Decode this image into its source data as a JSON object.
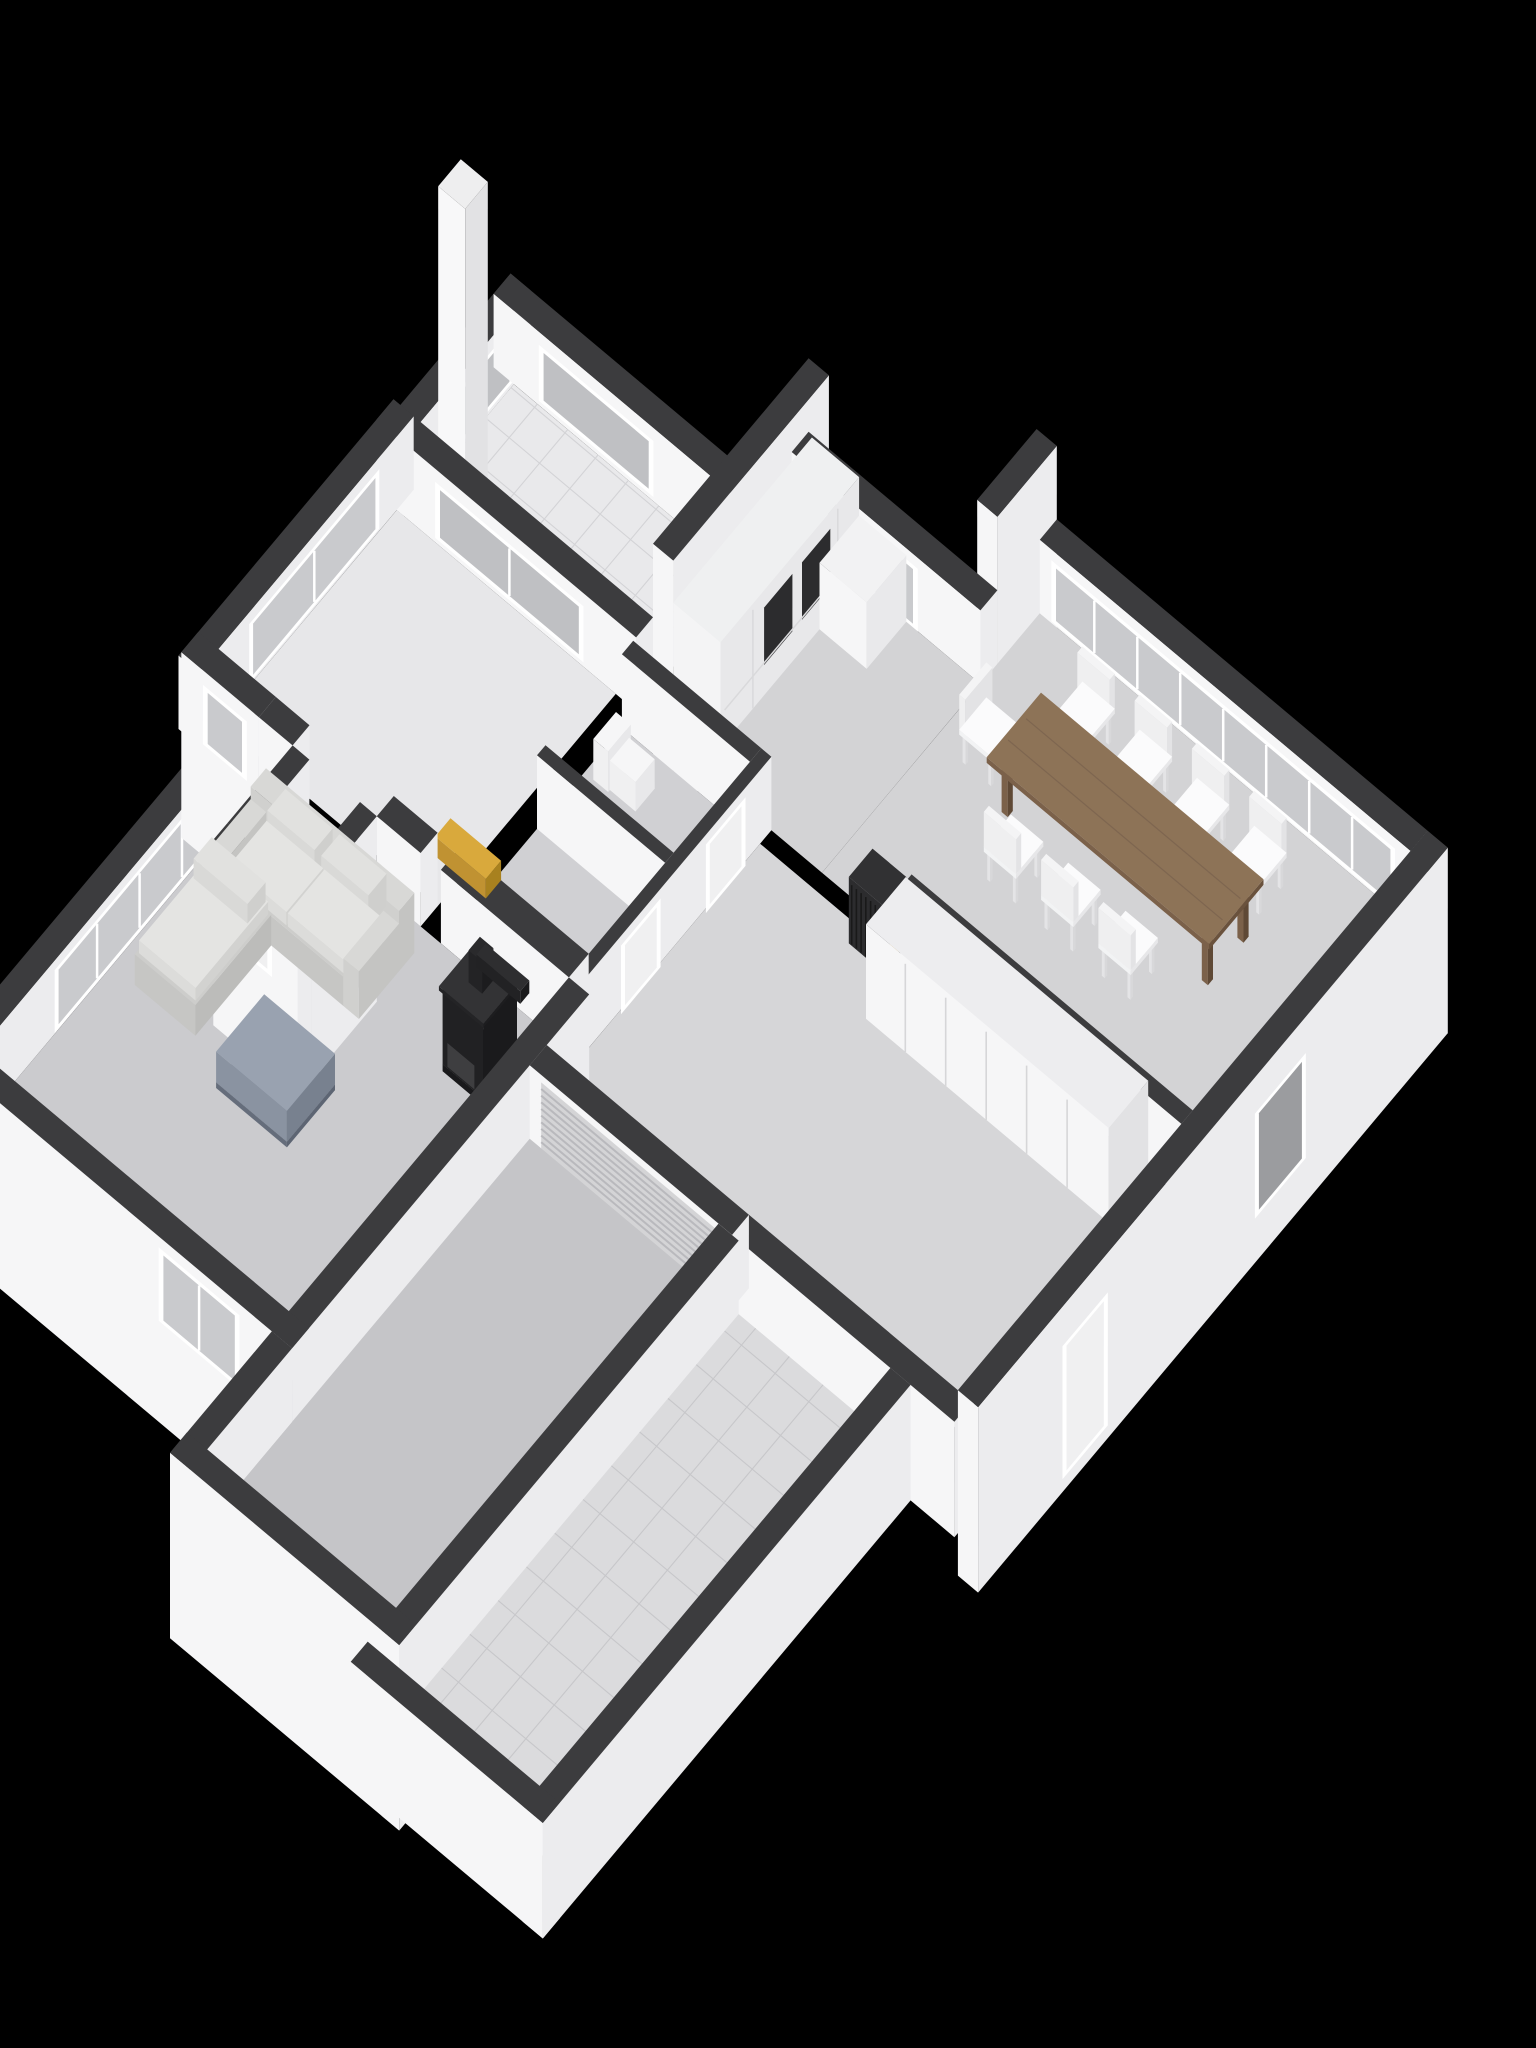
{
  "meta": {
    "kind": "3d-floorplan-axonometric-render",
    "background": "#000000",
    "floor_shown": "ground-floor",
    "visible_text": ""
  },
  "projection": {
    "ox": 520,
    "oy": 240,
    "s": 88,
    "c": 70,
    "ux": 0.766,
    "uy": 0.643,
    "vx": -0.643,
    "vy": 0.766
  },
  "palette": {
    "wallTop": "#3c3c3e",
    "wallV": "#f6f6f7",
    "wallU": "#ececee",
    "frame": "#ffffff",
    "glass": "#c9cacd",
    "glassFrost": "#bfc0c3",
    "glassDark": "#9b9c9f",
    "doorWhite": "#f0f0f1",
    "garageDoor": "#d4d4d6",
    "ribLine": "#b9b9bd",
    "tileA": "#e9e9eb",
    "tileAGrid": "#d3d3d6",
    "tileB": "#dbdbdd",
    "tileBGrid": "#c7c7ca",
    "floorBedroom": "#e7e7e9",
    "floorKitchen": "#d3d3d5",
    "floorCluster": "#d0d0d3",
    "floorCorridor": "#d6d6d8",
    "floorEntry": "#dedee0",
    "floorLiving": "#cbcbce",
    "floorGarage": "#c5c5c8",
    "wood": "#8d7357",
    "woodDark": "#6a523d",
    "woodSide": "#7b614a",
    "woodLeg": "#5f4936",
    "chairWhite": "#fbfbfc",
    "sofaBody": "#d8d8d6",
    "sofaBase": "#cdcdcb",
    "sofaCushion": "#e4e4e2",
    "ottomanTop": "#99a2b0",
    "ottomanU": "#78818f",
    "ottomanV": "#8a93a1",
    "stoveBlack": "#1a1a1c",
    "gold": "#d9a93c",
    "goldDark": "#a8811f",
    "goldMid": "#c09232",
    "radiatorDark": "#2c2c2e",
    "closetSeam": "#d6d6d8",
    "appliance": "#2c2c2e"
  },
  "scene": [
    {
      "name": "patio-floor",
      "type": "floor",
      "u": [
        1.0,
        4.45
      ],
      "v": [
        1.3,
        2.95
      ],
      "fill": "tileA",
      "grid": 0.45,
      "gridFill": "tileAGrid"
    },
    {
      "name": "patio-nw-wall",
      "type": "wall",
      "u": [
        0.7,
        1.0
      ],
      "v": [
        1.0,
        3.25
      ],
      "z": [
        0,
        1.05
      ]
    },
    {
      "name": "patio-nw-window",
      "type": "panel",
      "side": "u",
      "at": 1.0,
      "range": [
        1.35,
        2.6
      ],
      "z": [
        0.12,
        0.92
      ],
      "fill": "glassFrost",
      "frame": true
    },
    {
      "name": "patio-ne-wall",
      "type": "wall",
      "u": [
        0.7,
        4.45
      ],
      "v": [
        1.0,
        1.3
      ],
      "z": [
        0,
        1.05
      ]
    },
    {
      "name": "patio-ne-window",
      "type": "panel",
      "side": "v",
      "at": 1.3,
      "range": [
        1.4,
        3.1
      ],
      "z": [
        0.12,
        0.92
      ],
      "fill": "glassFrost",
      "frame": true
    },
    {
      "name": "chimney",
      "type": "wall",
      "u": [
        1.12,
        1.52
      ],
      "v": [
        2.38,
        2.78
      ],
      "z": [
        0,
        4.35
      ],
      "cols": {
        "t": "#eeeeef",
        "u": "#e2e2e4",
        "v": "#f8f8f9"
      }
    },
    {
      "name": "bedroom-ne-wall",
      "type": "wall",
      "u": [
        0.6,
        4.45
      ],
      "v": [
        2.95,
        3.25
      ],
      "z": [
        0,
        1.05
      ]
    },
    {
      "name": "bedroom-ne-window",
      "type": "panel",
      "side": "v",
      "at": 3.25,
      "range": [
        1.5,
        3.7
      ],
      "z": [
        0.12,
        0.92
      ],
      "fill": "glassFrost",
      "frame": true,
      "mull": 1
    },
    {
      "name": "bedroom-nw-wall",
      "type": "wall",
      "u": [
        0.6,
        0.9
      ],
      "v": [
        2.95,
        6.75
      ],
      "z": [
        0,
        1.05
      ]
    },
    {
      "name": "bedroom-nw-window",
      "type": "panel",
      "side": "u",
      "at": 0.9,
      "range": [
        3.6,
        5.9
      ],
      "z": [
        0.1,
        0.95
      ],
      "fill": "glass",
      "frame": true,
      "mull": 1
    },
    {
      "name": "bedroom-floor",
      "type": "floor",
      "u": [
        0.9,
        4.15
      ],
      "v": [
        3.25,
        6.4
      ],
      "fill": "floorBedroom"
    },
    {
      "name": "kitchen-nw-tall-wall",
      "type": "wall",
      "u": [
        4.45,
        4.75
      ],
      "v": [
        0.2,
        2.95
      ],
      "z": [
        -1.6,
        2.1
      ]
    },
    {
      "name": "kitchen-step-wall",
      "type": "wall",
      "u": [
        6.95,
        7.25
      ],
      "v": [
        -0.85,
        0.2
      ],
      "z": [
        -1.6,
        2.1
      ]
    },
    {
      "name": "kitchen-ne-wall",
      "type": "wall",
      "u": [
        4.45,
        7.25
      ],
      "v": [
        0.2,
        0.5
      ],
      "z": [
        0,
        1.05
      ]
    },
    {
      "name": "kitchen-patio-door",
      "type": "panel",
      "side": "v",
      "at": 0.5,
      "range": [
        4.95,
        6.35
      ],
      "z": [
        0.05,
        0.95
      ],
      "fill": "glass",
      "frame": true,
      "mull": 1
    },
    {
      "name": "kitchen-floor",
      "type": "floor",
      "u": [
        4.75,
        7.25
      ],
      "v": [
        0.5,
        3.3
      ],
      "fill": "floorKitchen"
    },
    {
      "name": "dining-floor",
      "type": "floor",
      "u": [
        7.25,
        12.75
      ],
      "v": [
        -0.55,
        3.3
      ],
      "fill": "floorKitchen"
    },
    {
      "name": "dining-ne-wall",
      "type": "wall",
      "u": [
        7.25,
        12.75
      ],
      "v": [
        -0.85,
        -0.55
      ],
      "z": [
        0,
        1.05
      ]
    },
    {
      "name": "dining-window-band",
      "type": "panel",
      "side": "v",
      "at": -0.55,
      "range": [
        7.45,
        12.55
      ],
      "z": [
        0.08,
        0.95
      ],
      "fill": "glass",
      "frame": true,
      "mull": 7
    },
    {
      "name": "kitchen-tall-cabinet",
      "type": "cabinet",
      "u": [
        4.75,
        5.45
      ],
      "v": [
        0.5,
        2.95
      ],
      "z": [
        0,
        1.5
      ]
    },
    {
      "name": "kitchen-counter",
      "type": "wall",
      "u": [
        5.45,
        6.15
      ],
      "v": [
        0.5,
        1.2
      ],
      "z": [
        0,
        0.95
      ],
      "cols": {
        "t": "#f2f2f3",
        "u": "#e9e9eb",
        "v": "#f6f6f7"
      }
    },
    {
      "name": "dining-chair",
      "type": "chair",
      "at": [
        8.6,
        0.26
      ],
      "face": "pv"
    },
    {
      "name": "dining-chair",
      "type": "chair",
      "at": [
        9.45,
        0.26
      ],
      "face": "pv"
    },
    {
      "name": "dining-chair",
      "type": "chair",
      "at": [
        10.3,
        0.26
      ],
      "face": "pv"
    },
    {
      "name": "dining-chair",
      "type": "chair",
      "at": [
        11.15,
        0.26
      ],
      "face": "pv"
    },
    {
      "name": "dining-chair",
      "type": "chair",
      "at": [
        7.88,
        1.1
      ],
      "face": "pu"
    },
    {
      "name": "dining-table",
      "type": "table",
      "u": [
        8.25,
        11.55
      ],
      "v": [
        0.62,
        1.58
      ]
    },
    {
      "name": "dining-chair",
      "type": "chair",
      "at": [
        8.95,
        1.94
      ],
      "face": "nv"
    },
    {
      "name": "dining-chair",
      "type": "chair",
      "at": [
        9.8,
        1.94
      ],
      "face": "nv"
    },
    {
      "name": "dining-chair",
      "type": "chair",
      "at": [
        10.65,
        1.94
      ],
      "face": "nv"
    },
    {
      "name": "corridor-nw-wall",
      "type": "wall",
      "u": [
        8.58,
        12.75
      ],
      "v": [
        3.3,
        3.5
      ],
      "z": [
        0,
        1.05
      ]
    },
    {
      "name": "cluster-ne-wall",
      "type": "wall",
      "u": [
        4.45,
        6.35
      ],
      "v": [
        3.3,
        3.5
      ],
      "z": [
        0,
        1.05
      ]
    },
    {
      "name": "cluster-floor",
      "type": "floor",
      "u": [
        4.45,
        6.35
      ],
      "v": [
        3.5,
        6.35
      ],
      "fill": "floorCluster"
    },
    {
      "name": "corridor-floor",
      "type": "floor",
      "u": [
        6.5,
        12.45
      ],
      "v": [
        3.5,
        7.45
      ],
      "fill": "floorCorridor"
    },
    {
      "name": "hall-radiator",
      "type": "radiator",
      "u": [
        8.0,
        8.5
      ],
      "v": [
        3.3,
        3.72
      ],
      "z": [
        0,
        0.95
      ]
    },
    {
      "name": "toilet",
      "type": "toilet",
      "at": [
        4.58,
        3.76
      ]
    },
    {
      "name": "cluster-mid-wall",
      "type": "wall",
      "u": [
        4.45,
        6.35
      ],
      "v": [
        4.85,
        5.0
      ],
      "z": [
        0,
        1.05
      ]
    },
    {
      "name": "cluster-se-wall",
      "type": "wall",
      "u": [
        6.35,
        6.5
      ],
      "v": [
        3.3,
        6.55
      ],
      "z": [
        0,
        1.05
      ]
    },
    {
      "name": "corridor-door",
      "type": "panel",
      "side": "u",
      "at": 6.5,
      "range": [
        3.8,
        4.5
      ],
      "z": [
        0,
        0.98
      ],
      "fill": "doorWhite",
      "frame": true
    },
    {
      "name": "corridor-door",
      "type": "panel",
      "side": "u",
      "at": 6.5,
      "range": [
        5.3,
        6.0
      ],
      "z": [
        0,
        0.98
      ],
      "fill": "doorWhite",
      "frame": true
    },
    {
      "name": "corridor-closets",
      "type": "closet",
      "u": [
        8.7,
        12.3
      ],
      "v": [
        3.55,
        4.25
      ],
      "z": [
        0,
        1.35
      ],
      "doors": 6
    },
    {
      "name": "cluster-sw-wall",
      "type": "wall",
      "u": [
        4.45,
        6.35
      ],
      "v": [
        6.35,
        6.7
      ],
      "z": [
        0,
        1.05
      ]
    },
    {
      "name": "wall-radiator-gold",
      "type": "goldbar",
      "u": [
        4.3,
        5.05
      ],
      "v": [
        6.35,
        6.62
      ],
      "z": [
        1.05,
        1.33
      ]
    },
    {
      "name": "living-nw-wall",
      "type": "wall",
      "u": [
        1.45,
        1.75
      ],
      "v": [
        6.7,
        11.95
      ],
      "z": [
        0,
        1.05
      ]
    },
    {
      "name": "living-nw-sliding-glass",
      "type": "panel",
      "side": "u",
      "at": 1.75,
      "range": [
        7.35,
        10.35
      ],
      "z": [
        0.08,
        0.98
      ],
      "fill": "glass",
      "frame": true,
      "mull": 3
    },
    {
      "name": "living-floor",
      "type": "floor",
      "u": [
        1.75,
        6.35
      ],
      "v": [
        6.7,
        11.65
      ],
      "fill": "floorLiving"
    },
    {
      "name": "bedroom-sw-wall",
      "type": "wall",
      "u": [
        0.6,
        1.75
      ],
      "v": [
        6.4,
        6.7
      ],
      "z": [
        -1.6,
        1.05
      ]
    },
    {
      "name": "bedroom-sw-window",
      "type": "panel",
      "side": "v",
      "at": 6.7,
      "range": [
        0.95,
        1.6
      ],
      "z": [
        0.05,
        0.9
      ],
      "fill": "glass",
      "frame": true
    },
    {
      "name": "living-ne-wall-stub",
      "type": "wall",
      "u": [
        1.75,
        2.25
      ],
      "v": [
        6.4,
        6.7
      ],
      "z": [
        0,
        1.05
      ]
    },
    {
      "name": "bedroom-sw-wall-b",
      "type": "wall",
      "u": [
        3.5,
        4.15
      ],
      "v": [
        6.4,
        6.7
      ],
      "z": [
        0,
        1.05
      ]
    },
    {
      "name": "entry-side-wall-a",
      "type": "wall",
      "u": [
        2.25,
        2.5
      ],
      "v": [
        6.7,
        7.85
      ],
      "z": [
        -1.6,
        1.05
      ]
    },
    {
      "name": "entry-side-wall-b",
      "type": "wall",
      "u": [
        3.25,
        3.5
      ],
      "v": [
        6.7,
        7.85
      ],
      "z": [
        -1.6,
        1.05
      ]
    },
    {
      "name": "entry-floor",
      "type": "floor",
      "u": [
        2.5,
        3.25
      ],
      "v": [
        6.7,
        7.85
      ],
      "fill": "floorEntry"
    },
    {
      "name": "entry-front-wall",
      "type": "wall",
      "u": [
        2.25,
        3.5
      ],
      "v": [
        7.85,
        8.1
      ],
      "z": [
        -1.6,
        1.05
      ]
    },
    {
      "name": "entry-door",
      "type": "panel",
      "side": "v",
      "at": 8.1,
      "range": [
        2.6,
        3.15
      ],
      "z": [
        -0.15,
        0.92
      ],
      "fill": "doorWhite",
      "frame": true
    },
    {
      "name": "sofa",
      "type": "sofa",
      "at": [
        2.15,
        7.05
      ]
    },
    {
      "name": "ottoman",
      "type": "ottoman",
      "u": [
        3.55,
        4.6
      ],
      "v": [
        8.75,
        9.6
      ],
      "z": [
        0,
        0.52
      ]
    },
    {
      "name": "wood-stove",
      "type": "stove",
      "u": [
        5.4,
        6.0
      ],
      "v": [
        7.2,
        7.8
      ]
    },
    {
      "name": "living-se-tall-wall",
      "type": "wall",
      "u": [
        6.35,
        6.65
      ],
      "v": [
        6.7,
        11.95
      ],
      "z": [
        -1.6,
        1.05
      ]
    },
    {
      "name": "living-sw-wall",
      "type": "wall",
      "u": [
        1.45,
        6.65
      ],
      "v": [
        11.65,
        11.95
      ],
      "z": [
        -1.6,
        1.05
      ]
    },
    {
      "name": "living-sw-sliding-door",
      "type": "panel",
      "side": "v",
      "at": 11.95,
      "range": [
        4.7,
        5.9
      ],
      "z": [
        -0.1,
        0.95
      ],
      "fill": "glass",
      "frame": true,
      "mull": 1
    },
    {
      "name": "rightwing-sw-wall-terrace",
      "type": "wall",
      "u": [
        9.65,
        12.95
      ],
      "v": [
        7.45,
        7.75
      ],
      "z": [
        -0.6,
        1.05
      ]
    },
    {
      "name": "rightwing-sw-wall-garage",
      "type": "wall",
      "u": [
        6.65,
        9.65
      ],
      "v": [
        7.45,
        7.75
      ],
      "z": [
        0,
        1.05
      ]
    },
    {
      "name": "garage-door",
      "type": "panel",
      "side": "v",
      "at": 7.75,
      "range": [
        6.85,
        9.45
      ],
      "z": [
        0.05,
        1.0
      ],
      "fill": "garageDoor",
      "ribs": 9
    },
    {
      "name": "garage-floor",
      "type": "floor",
      "u": [
        6.65,
        9.45
      ],
      "v": [
        7.75,
        13.45
      ],
      "fill": "floorGarage"
    },
    {
      "name": "garage-nw-wall",
      "type": "wall",
      "u": [
        6.35,
        6.65
      ],
      "v": [
        11.95,
        13.75
      ],
      "z": [
        0,
        1.05
      ]
    },
    {
      "name": "garage-se-wall",
      "type": "wall",
      "u": [
        9.45,
        9.75
      ],
      "v": [
        7.75,
        13.75
      ],
      "z": [
        -0.6,
        1.05
      ]
    },
    {
      "name": "terrace-floor",
      "type": "floor",
      "u": [
        9.75,
        12.0
      ],
      "v": [
        7.75,
        13.95
      ],
      "fill": "tileB",
      "grid": 0.5,
      "gridFill": "tileBGrid"
    },
    {
      "name": "garage-sw-wall",
      "type": "wall",
      "u": [
        6.35,
        9.75
      ],
      "v": [
        13.45,
        13.75
      ],
      "z": [
        -1.6,
        1.05
      ]
    },
    {
      "name": "terrace-se-wall",
      "type": "wall",
      "u": [
        12.0,
        12.3
      ],
      "v": [
        7.75,
        14.25
      ],
      "z": [
        -0.6,
        1.05
      ]
    },
    {
      "name": "terrace-sw-wall",
      "type": "wall",
      "u": [
        9.45,
        12.3
      ],
      "v": [
        13.95,
        14.25
      ],
      "z": [
        -0.6,
        1.05
      ]
    },
    {
      "name": "rightwing-se-tall-wall",
      "type": "wall",
      "u": [
        12.75,
        13.05
      ],
      "v": [
        -0.85,
        7.45
      ],
      "z": [
        -1.6,
        1.05
      ]
    },
    {
      "name": "rightwing-se-window-recess",
      "type": "panel",
      "side": "u",
      "at": 13.05,
      "range": [
        1.7,
        2.6
      ],
      "z": [
        -0.9,
        0.6
      ],
      "fill": "glassDark",
      "frame": true
    },
    {
      "name": "rightwing-se-door-recess",
      "type": "panel",
      "side": "u",
      "at": 13.05,
      "range": [
        5.2,
        6.0
      ],
      "z": [
        -1.35,
        0.55
      ],
      "fill": "doorWhite",
      "frame": true
    }
  ]
}
